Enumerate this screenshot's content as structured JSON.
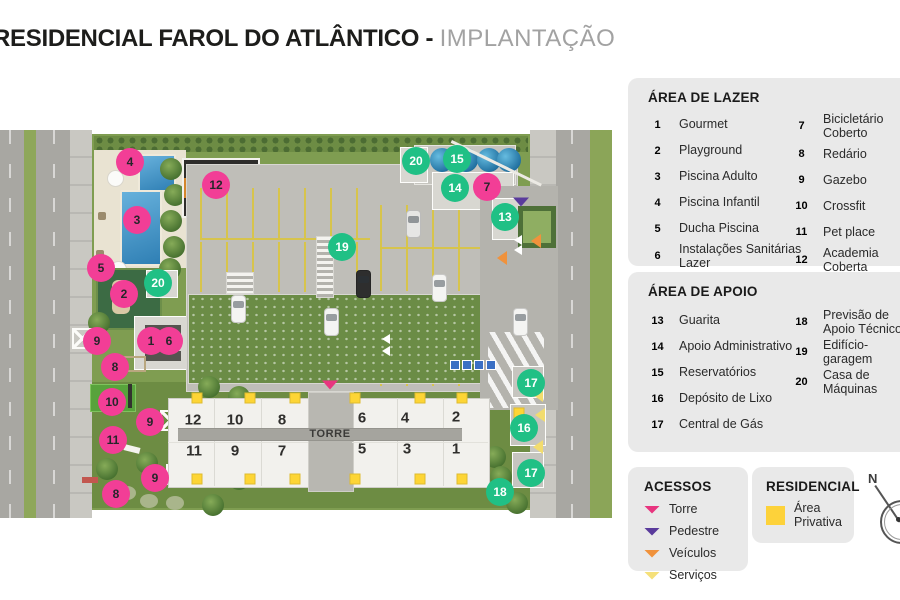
{
  "title": {
    "main": "RESIDENCIAL FAROL DO ATLÂNTICO -",
    "sub": "IMPLANTAÇÃO"
  },
  "colors": {
    "lazer_pink": "#f23e96",
    "apoio_green": "#20c085",
    "privativa_yellow": "#fdd23a",
    "torre_arrow": "#e8357f",
    "pedestre_arrow": "#5a3b9c",
    "veiculos_arrow": "#f0923c",
    "servicos_arrow": "#f5e07a"
  },
  "legends": {
    "lazer": {
      "header": "ÁREA DE LAZER",
      "col1": [
        {
          "num": "1",
          "label": "Gourmet",
          "type": "lazer"
        },
        {
          "num": "2",
          "label": "Playground",
          "type": "lazer"
        },
        {
          "num": "3",
          "label": "Piscina Adulto",
          "type": "lazer"
        },
        {
          "num": "4",
          "label": "Piscina Infantil",
          "type": "lazer"
        },
        {
          "num": "5",
          "label": "Ducha Piscina",
          "type": "lazer"
        },
        {
          "num": "6",
          "label": "Instalações Sanitárias Lazer",
          "type": "lazer"
        }
      ],
      "col2": [
        {
          "num": "7",
          "label": "Bicicletário Coberto",
          "type": "lazer"
        },
        {
          "num": "8",
          "label": "Redário",
          "type": "lazer"
        },
        {
          "num": "9",
          "label": "Gazebo",
          "type": "lazer"
        },
        {
          "num": "10",
          "label": "Crossfit",
          "type": "lazer"
        },
        {
          "num": "11",
          "label": "Pet place",
          "type": "lazer"
        },
        {
          "num": "12",
          "label": "Academia Coberta",
          "type": "lazer"
        }
      ]
    },
    "apoio": {
      "header": "ÁREA DE APOIO",
      "col1": [
        {
          "num": "13",
          "label": "Guarita",
          "type": "apoio"
        },
        {
          "num": "14",
          "label": "Apoio Administrativo",
          "type": "apoio"
        },
        {
          "num": "15",
          "label": "Reservatórios",
          "type": "apoio"
        },
        {
          "num": "16",
          "label": "Depósito de Lixo",
          "type": "apoio"
        },
        {
          "num": "17",
          "label": "Central de Gás",
          "type": "apoio"
        }
      ],
      "col2": [
        {
          "num": "18",
          "label": "Previsão de Apoio Técnico",
          "type": "apoio"
        },
        {
          "num": "19",
          "label": "Edifício-garagem",
          "type": "apoio"
        },
        {
          "num": "20",
          "label": "Casa de Máquinas",
          "type": "apoio"
        }
      ]
    },
    "acessos": {
      "header": "ACESSOS",
      "items": [
        {
          "label": "Torre",
          "color": "#e8357f"
        },
        {
          "label": "Pedestre",
          "color": "#5a3b9c"
        },
        {
          "label": "Veículos",
          "color": "#f0923c"
        },
        {
          "label": "Serviços",
          "color": "#f5e07a"
        }
      ]
    },
    "residencial": {
      "header": "RESIDENCIAL",
      "item": "Área Privativa"
    },
    "compass": {
      "label": "N"
    }
  },
  "map": {
    "torre_label": "TORRE",
    "units": [
      {
        "n": "12",
        "x": 193,
        "y": 420
      },
      {
        "n": "10",
        "x": 235,
        "y": 420
      },
      {
        "n": "8",
        "x": 282,
        "y": 420
      },
      {
        "n": "6",
        "x": 362,
        "y": 418
      },
      {
        "n": "4",
        "x": 405,
        "y": 418
      },
      {
        "n": "2",
        "x": 456,
        "y": 417
      },
      {
        "n": "11",
        "x": 194,
        "y": 451
      },
      {
        "n": "9",
        "x": 235,
        "y": 451
      },
      {
        "n": "7",
        "x": 282,
        "y": 451
      },
      {
        "n": "5",
        "x": 362,
        "y": 449
      },
      {
        "n": "3",
        "x": 407,
        "y": 449
      },
      {
        "n": "1",
        "x": 456,
        "y": 449
      }
    ],
    "markers": [
      {
        "n": "4",
        "x": 130,
        "y": 162,
        "type": "lazer"
      },
      {
        "n": "12",
        "x": 216,
        "y": 185,
        "type": "lazer"
      },
      {
        "n": "3",
        "x": 137,
        "y": 220,
        "type": "lazer"
      },
      {
        "n": "5",
        "x": 101,
        "y": 268,
        "type": "lazer"
      },
      {
        "n": "20",
        "x": 158,
        "y": 283,
        "type": "apoio"
      },
      {
        "n": "2",
        "x": 124,
        "y": 294,
        "type": "lazer"
      },
      {
        "n": "9",
        "x": 97,
        "y": 341,
        "type": "lazer"
      },
      {
        "n": "1",
        "x": 151,
        "y": 341,
        "type": "lazer"
      },
      {
        "n": "6",
        "x": 169,
        "y": 341,
        "type": "lazer"
      },
      {
        "n": "8",
        "x": 115,
        "y": 367,
        "type": "lazer"
      },
      {
        "n": "10",
        "x": 112,
        "y": 402,
        "type": "lazer"
      },
      {
        "n": "9",
        "x": 150,
        "y": 422,
        "type": "lazer"
      },
      {
        "n": "11",
        "x": 113,
        "y": 440,
        "type": "lazer"
      },
      {
        "n": "9",
        "x": 155,
        "y": 478,
        "type": "lazer"
      },
      {
        "n": "8",
        "x": 116,
        "y": 494,
        "type": "lazer"
      },
      {
        "n": "19",
        "x": 342,
        "y": 247,
        "type": "apoio"
      },
      {
        "n": "20",
        "x": 416,
        "y": 161,
        "type": "apoio"
      },
      {
        "n": "15",
        "x": 457,
        "y": 159,
        "type": "apoio"
      },
      {
        "n": "14",
        "x": 455,
        "y": 188,
        "type": "apoio"
      },
      {
        "n": "7",
        "x": 487,
        "y": 187,
        "type": "lazer"
      },
      {
        "n": "13",
        "x": 505,
        "y": 217,
        "type": "apoio"
      },
      {
        "n": "17",
        "x": 531,
        "y": 383,
        "type": "apoio"
      },
      {
        "n": "16",
        "x": 524,
        "y": 428,
        "type": "apoio"
      },
      {
        "n": "17",
        "x": 531,
        "y": 473,
        "type": "apoio"
      },
      {
        "n": "18",
        "x": 500,
        "y": 492,
        "type": "apoio"
      }
    ],
    "privativa": [
      {
        "x": 197,
        "y": 398
      },
      {
        "x": 250,
        "y": 398
      },
      {
        "x": 295,
        "y": 398
      },
      {
        "x": 355,
        "y": 398
      },
      {
        "x": 420,
        "y": 398
      },
      {
        "x": 462,
        "y": 398
      },
      {
        "x": 197,
        "y": 479
      },
      {
        "x": 250,
        "y": 479
      },
      {
        "x": 295,
        "y": 479
      },
      {
        "x": 355,
        "y": 479
      },
      {
        "x": 420,
        "y": 479
      },
      {
        "x": 462,
        "y": 479
      },
      {
        "x": 519,
        "y": 413
      }
    ]
  }
}
